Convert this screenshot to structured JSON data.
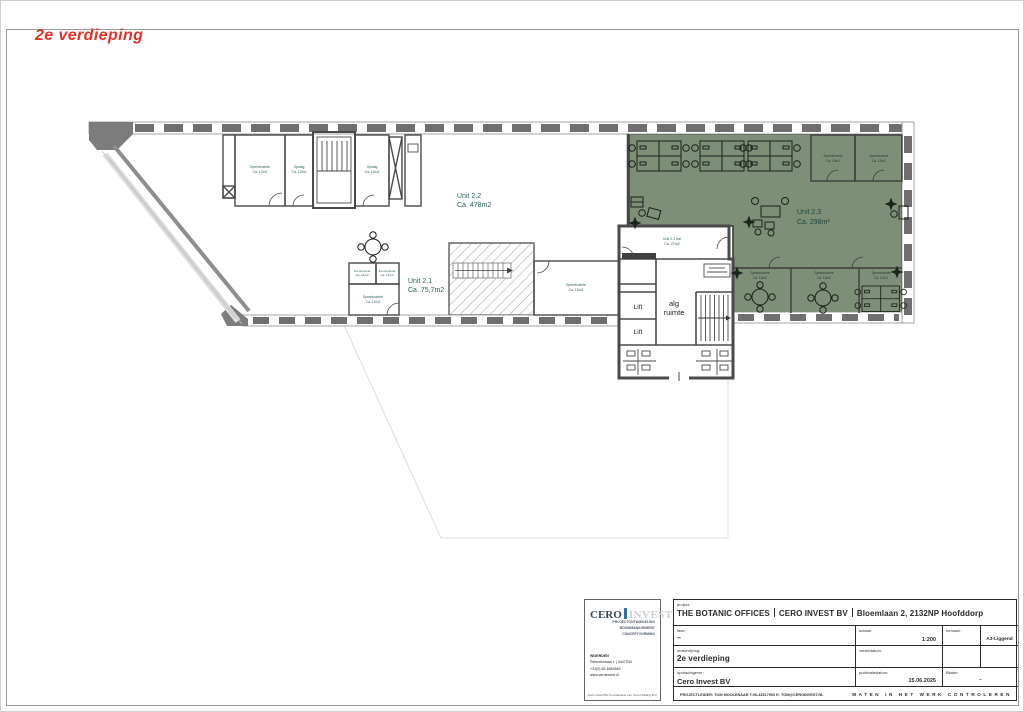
{
  "page": {
    "sheet_title": "2e verdieping"
  },
  "plan": {
    "units": {
      "unit22": {
        "name": "Unit 2.2",
        "area": "Ca. 478m2"
      },
      "unit21": {
        "name": "Unit 2.1",
        "area": "Ca. 75,7m2"
      },
      "unit23": {
        "name": "Unit 2.3",
        "area": "Ca. 298m²"
      },
      "unit21hal": {
        "name": "Unit 2.1 hal",
        "area": "Ca. 27m2"
      }
    },
    "labels": {
      "lift": "Lift",
      "alg_line1": "alg",
      "alg_line2": "ruimte",
      "spreekruimte": "Spreekruimte",
      "opslag": "Opslag",
      "focusruimte": "Focusruimte",
      "area_small": "Ca. 12m2"
    },
    "colors": {
      "zone_green": "#7E8F77",
      "wall_gray": "#6F6F6F",
      "label_teal": "#2B5F5A",
      "title_red": "#E73127"
    }
  },
  "title_block": {
    "labels": {
      "project": "project:",
      "fase": "fase:",
      "schaal": "schaal:",
      "formaat": "formaat:",
      "omschrijving": "omschrijving:",
      "versiedatum": "versiedatum:",
      "opdrachtgever": "opdrachtgever:",
      "publicatiedatum": "publicatiedatum:",
      "bladnr": "Bladnr:"
    },
    "values": {
      "project_parts": [
        "THE BOTANIC OFFICES",
        "CERO INVEST BV",
        "Bloemlaan 2, 2132NP Hoofddorp"
      ],
      "fase": "–",
      "schaal": "1:200",
      "formaat": "A3-Liggend",
      "omschrijving": "2e verdieping",
      "versiedatum": "",
      "opdrachtgever": "Cero Invest BV",
      "publicatiedatum": "15.06.2025",
      "bladnr": "–"
    },
    "projectleider": "PROJECTLEIDER: TOM MOOLENAAR T:06-43517993 E: TOM@CEROINVEST.NL",
    "note": "MATEN IN HET WERK CONTROLEREN"
  },
  "logo": {
    "brand_left": "CERO",
    "brand_right": "INVEST",
    "reg": "®",
    "tagline_lines": [
      "PROJECTONTWIKKELING",
      "BOUWMANAGEMENT",
      "CONCEPTVORMING"
    ],
    "address_lines": [
      "WOERDEN",
      "Pelmolenlaan 1 | 3447GW",
      "+31(0) 85 4862845",
      "www.ceroinvest.nl"
    ],
    "footer": "Cero Invest BV is onderdeel van Cero Holding B.V."
  }
}
